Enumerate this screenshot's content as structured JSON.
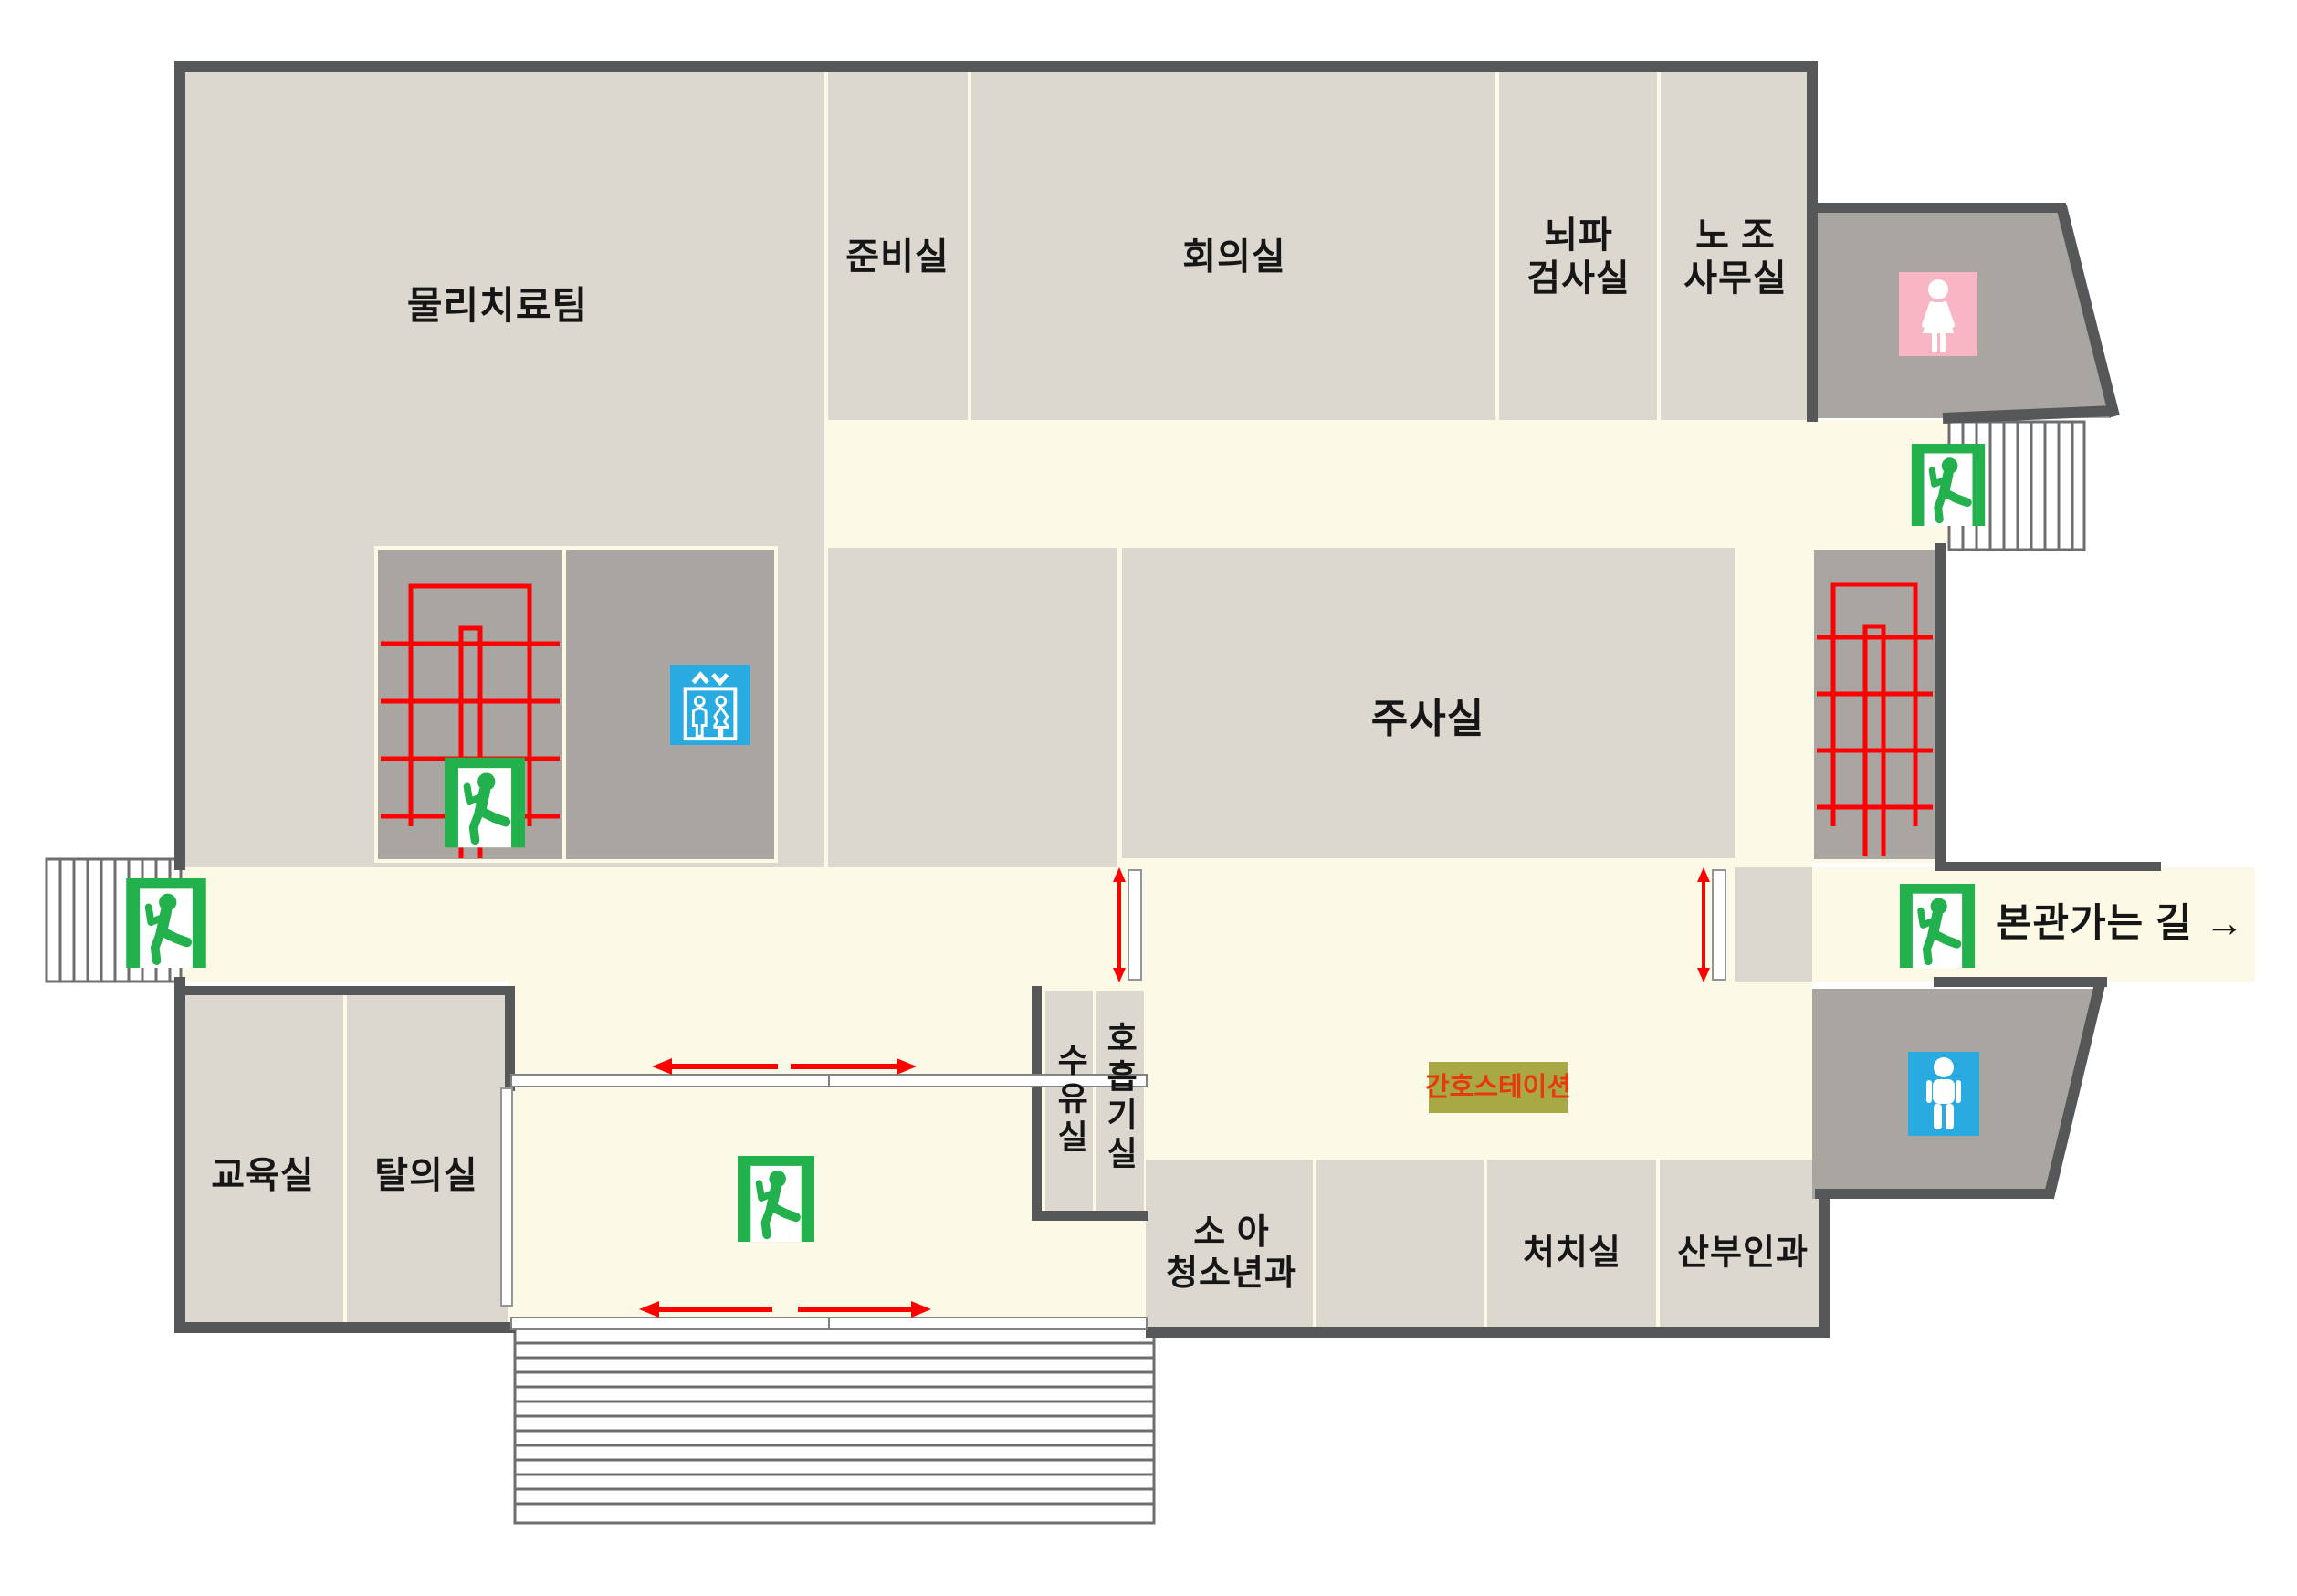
{
  "rooms": {
    "physio": "물리치료팀",
    "prep": "준비실",
    "meeting": "회의실",
    "eeg": "뇌파\n검사실",
    "union": "노  조\n사무실",
    "injection": "주사실",
    "education": "교육실",
    "changing": "탈의실",
    "nursing": "수유실",
    "respiratory": "호흡기실",
    "pediatrics": "소  아\n청소년과",
    "treatment": "처치실",
    "obgyn": "산부인과"
  },
  "labels": {
    "nurse_station": "간호스테이션",
    "to_main_building": "본관가는 길 →"
  },
  "icons": {
    "exit": "exit-man-icon",
    "elevator": "elevator-icon",
    "toilet_female": "female-toilet-icon",
    "toilet_male": "male-toilet-icon",
    "stairs": "stairs-symbol"
  },
  "colors": {
    "wall": "#565759",
    "room_fill": "#dcd8d0",
    "corridor_fill": "#fcfae6",
    "block_fill": "#a9a5a0",
    "stair_red": "#ff0000",
    "exit_green": "#22b14c",
    "elevator_blue": "#29abe2",
    "toilet_pink": "#f8b5c4",
    "toilet_blue": "#29abe2",
    "nurse_station_bg": "#a8a944",
    "nurse_station_text": "#e8380d",
    "step_line": "#6d6e70"
  }
}
